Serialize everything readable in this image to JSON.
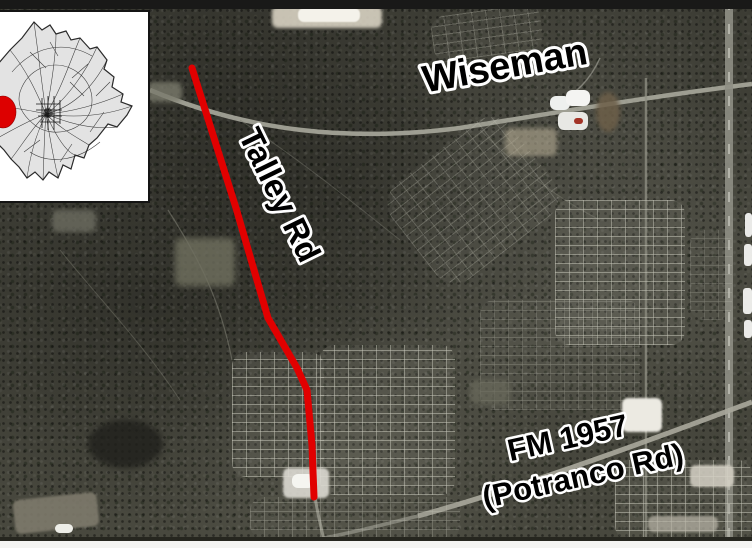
{
  "map_labels": {
    "road_top": "Wiseman",
    "highlighted_road": "Talley Rd",
    "road_bottom_line1": "FM 1957",
    "road_bottom_line2": "(Potranco Rd)"
  },
  "colors": {
    "route_highlight": "#e10000",
    "inset_marker": "#dd0000",
    "label_ink": "#000000",
    "label_halo": "#ffffff",
    "inset_land": "#e3e3e3"
  }
}
